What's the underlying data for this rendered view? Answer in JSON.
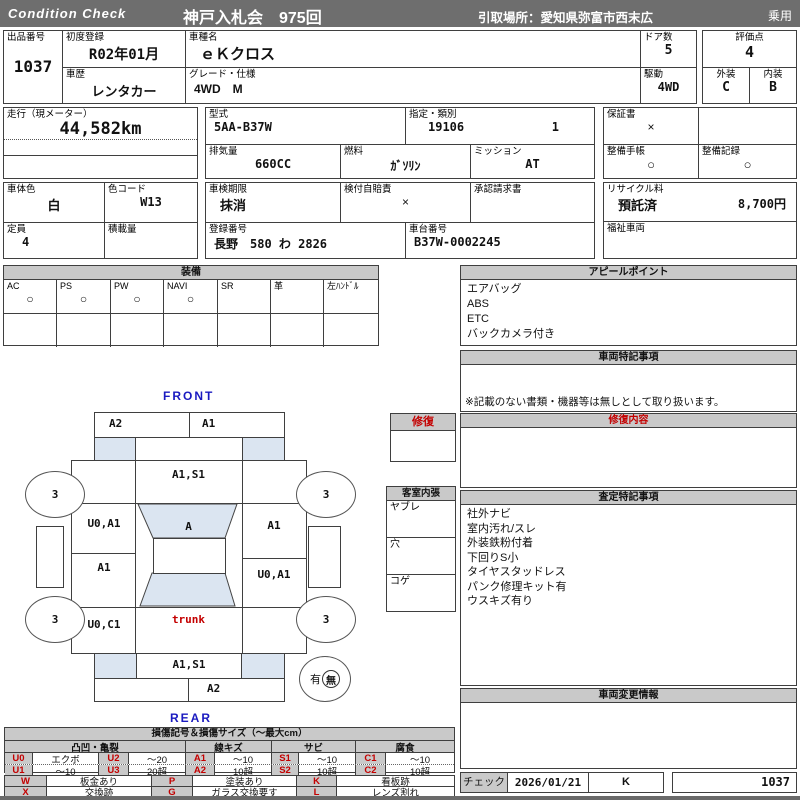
{
  "header": {
    "brand": "Condition  Check",
    "auction": "神戸入札会　975回",
    "pickup": "引取場所：愛知県弥富市西末広",
    "category": "乗用"
  },
  "fields": {
    "lot_label": "出品番号",
    "lot": "1037",
    "first_reg_label": "初度登録",
    "first_reg": "R02年01月",
    "history_label": "車歴",
    "history": "レンタカー",
    "model_label": "車種名",
    "model": "ｅＫクロス",
    "grade_label": "グレード・仕様",
    "grade": "4WD　M",
    "doors_label": "ドア数",
    "doors": "5",
    "score_label": "評価点",
    "score": "4",
    "drive_label": "駆動",
    "drive": "4WD",
    "ext_label": "外装",
    "ext": "C",
    "int_label": "内装",
    "int": "B",
    "mileage_label": "走行（現メーター）",
    "mileage": "44,582km",
    "model_code_label": "型式",
    "model_code": "5AA-B37W",
    "class_label": "指定・類別",
    "class1": "19106",
    "class2": "1",
    "warranty_label": "保証書",
    "warranty": "×",
    "disp_label": "排気量",
    "disp": "660CC",
    "fuel_label": "燃料",
    "fuel": "ｶﾞｿﾘﾝ",
    "mission_label": "ミッション",
    "mission": "AT",
    "maint_book_label": "整備手帳",
    "maint_book": "○",
    "maint_rec_label": "整備記録",
    "maint_rec": "○",
    "color_label": "車体色",
    "color": "白",
    "colorcode_label": "色コード",
    "colorcode": "W13",
    "inspection_label": "車検期限",
    "inspection": "抹消",
    "jibai_label": "検付自賠責",
    "jibai": "×",
    "approval_label": "承認請求書",
    "recycle_label": "リサイクル料",
    "recycle_status": "預託済",
    "recycle_fee": "8,700円",
    "capacity_label": "定員",
    "capacity": "4",
    "load_label": "積載量",
    "regno_label": "登録番号",
    "regno": "長野　580 わ 2826",
    "chassis_label": "車台番号",
    "chassis": "B37W-0002245",
    "welfare_label": "福祉車両"
  },
  "equipment": {
    "title": "装備",
    "items": [
      {
        "label": "AC",
        "mark": "○"
      },
      {
        "label": "PS",
        "mark": "○"
      },
      {
        "label": "PW",
        "mark": "○"
      },
      {
        "label": "NAVI",
        "mark": "○"
      },
      {
        "label": "SR",
        "mark": ""
      },
      {
        "label": "革",
        "mark": ""
      },
      {
        "label": "左ﾊﾝﾄﾞﾙ",
        "mark": ""
      }
    ]
  },
  "panels": {
    "appeal": {
      "title": "アピールポイント",
      "items": [
        "エアバッグ",
        "ABS",
        "ETC",
        "バックカメラ付き"
      ]
    },
    "vehicle_notes": {
      "title": "車両特記事項",
      "note": "※記載のない書類・機器等は無しとして取り扱います。"
    },
    "repair": {
      "title": "修復内容"
    },
    "assessment": {
      "title": "査定特記事項",
      "items": [
        "社外ナビ",
        "室内汚れ/スレ",
        "外装鉄粉付着",
        "下回りS小",
        "タイヤスタッドレス",
        "パンク修理キット有",
        "ウスキズ有り"
      ]
    },
    "changes": {
      "title": "車両変更情報"
    }
  },
  "check": {
    "label": "チェック",
    "date": "2026/01/21",
    "inspector": "K",
    "lot": "1037"
  },
  "diagram": {
    "front": "FRONT",
    "rear": "REAR",
    "front_bumper_l": "A2",
    "front_bumper_r": "A1",
    "hood": "A1,S1",
    "front_left": "U0,A1",
    "windshield": "A",
    "front_right": "A1",
    "side_left": "A1",
    "side_right": "U0,A1",
    "rear_left": "U0,C1",
    "trunk": "trunk",
    "rear_panel": "A1,S1",
    "rear_bumper": "A2",
    "wheel": "3",
    "spare_yes": "有",
    "spare_no": "無",
    "repair_box": "修復",
    "interior": {
      "title": "客室内張",
      "items": [
        "ヤブレ",
        "穴",
        "コゲ"
      ]
    }
  },
  "legend": {
    "title": "損傷記号＆損傷サイズ（〜最大cm）",
    "groups": [
      "凸凹・亀裂",
      "線キズ",
      "サビ",
      "腐食"
    ],
    "rows": [
      [
        "U0",
        "エクボ",
        "U2",
        "〜20",
        "A1",
        "〜10",
        "S1",
        "〜10",
        "C1",
        "〜10"
      ],
      [
        "U1",
        "〜10",
        "U3",
        "20超",
        "A2",
        "10超",
        "S2",
        "10超",
        "C2",
        "10超"
      ]
    ],
    "codes": [
      [
        "W",
        "板金あり",
        "P",
        "塗装あり",
        "K",
        "看板跡"
      ],
      [
        "X",
        "交換跡",
        "G",
        "ガラス交換要す",
        "L",
        "レンズ割れ"
      ]
    ]
  }
}
